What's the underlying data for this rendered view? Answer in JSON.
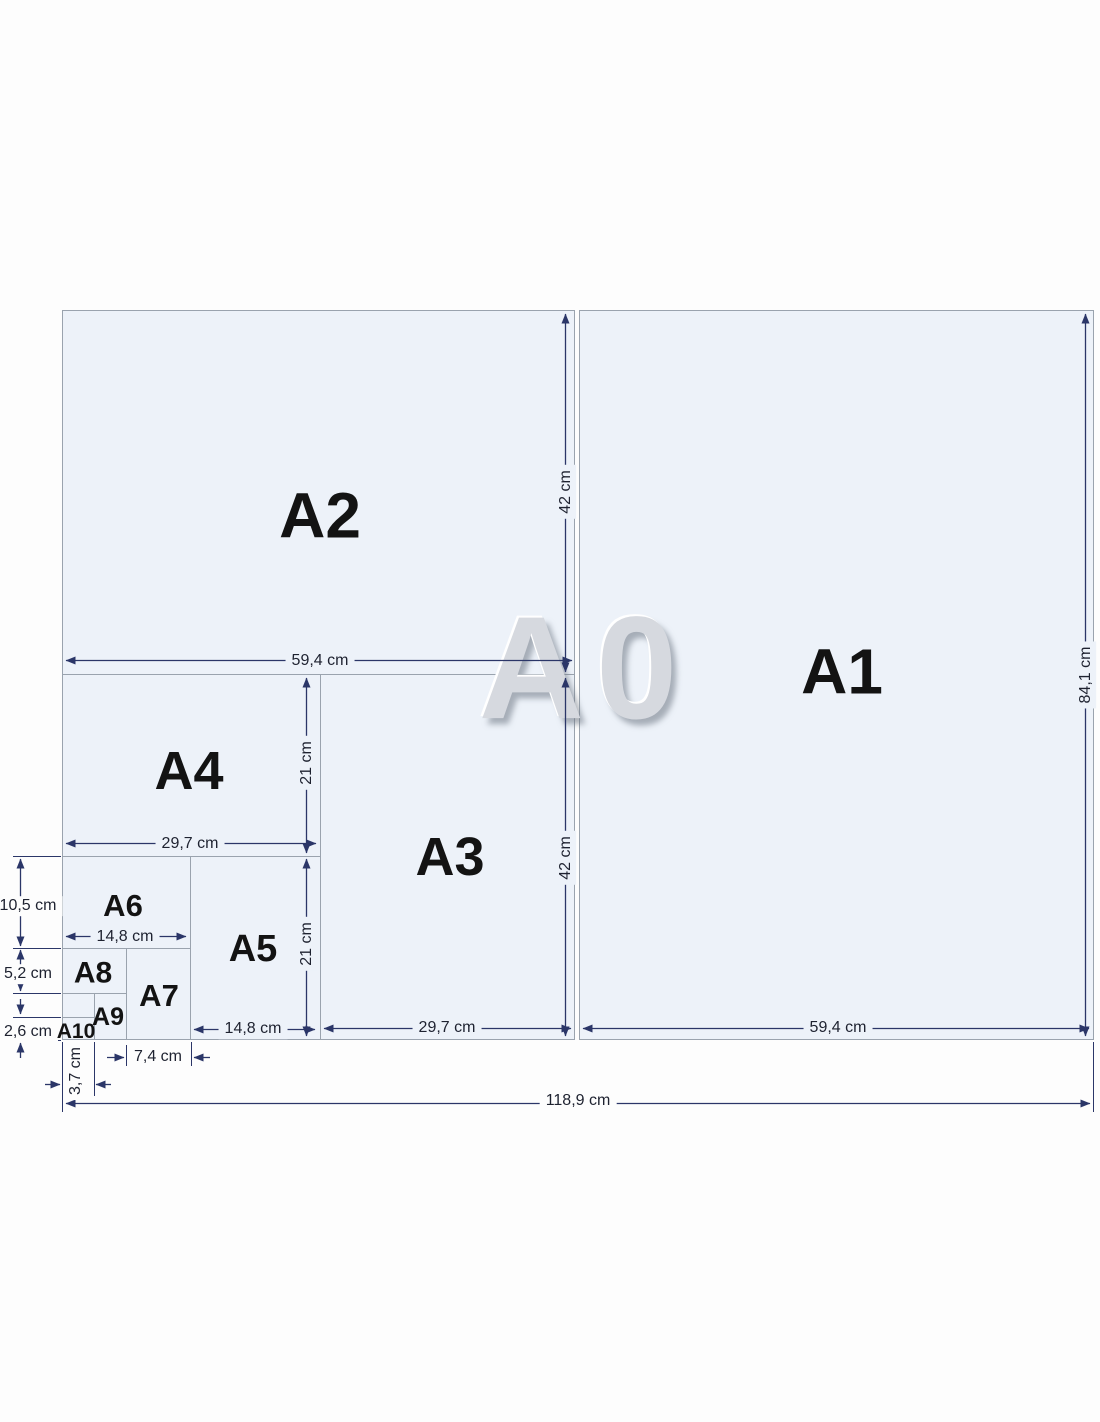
{
  "diagram": {
    "subject": "ISO A-series paper sizes",
    "watermark_label": "A0"
  },
  "papers": {
    "a1": "A1",
    "a2": "A2",
    "a3": "A3",
    "a4": "A4",
    "a5": "A5",
    "a6": "A6",
    "a7": "A7",
    "a8": "A8",
    "a9": "A9",
    "a10": "A10"
  },
  "dims": {
    "a2_width": "59,4 cm",
    "a2_height": "42 cm",
    "a0_height": "84,1 cm",
    "a3_height": "42 cm",
    "a4_width": "29,7 cm",
    "a4_height": "21 cm",
    "a6_height": "10,5 cm",
    "a6_width": "14,8 cm",
    "a8_height": "5,2 cm",
    "a10_height": "2,6 cm",
    "a5_height": "21 cm",
    "a5_width": "14,8 cm",
    "a3_width": "29,7 cm",
    "a1_width": "59,4 cm",
    "a7_width": "7,4 cm",
    "a10_width": "3,7 cm",
    "a0_width": "118,9 cm"
  },
  "colors": {
    "paper_fill": "#edf2f9",
    "paper_border": "#9aa3ae",
    "dimension_line": "#2b3668",
    "label_text": "#131313",
    "watermark_gray": "#d6d9df"
  }
}
